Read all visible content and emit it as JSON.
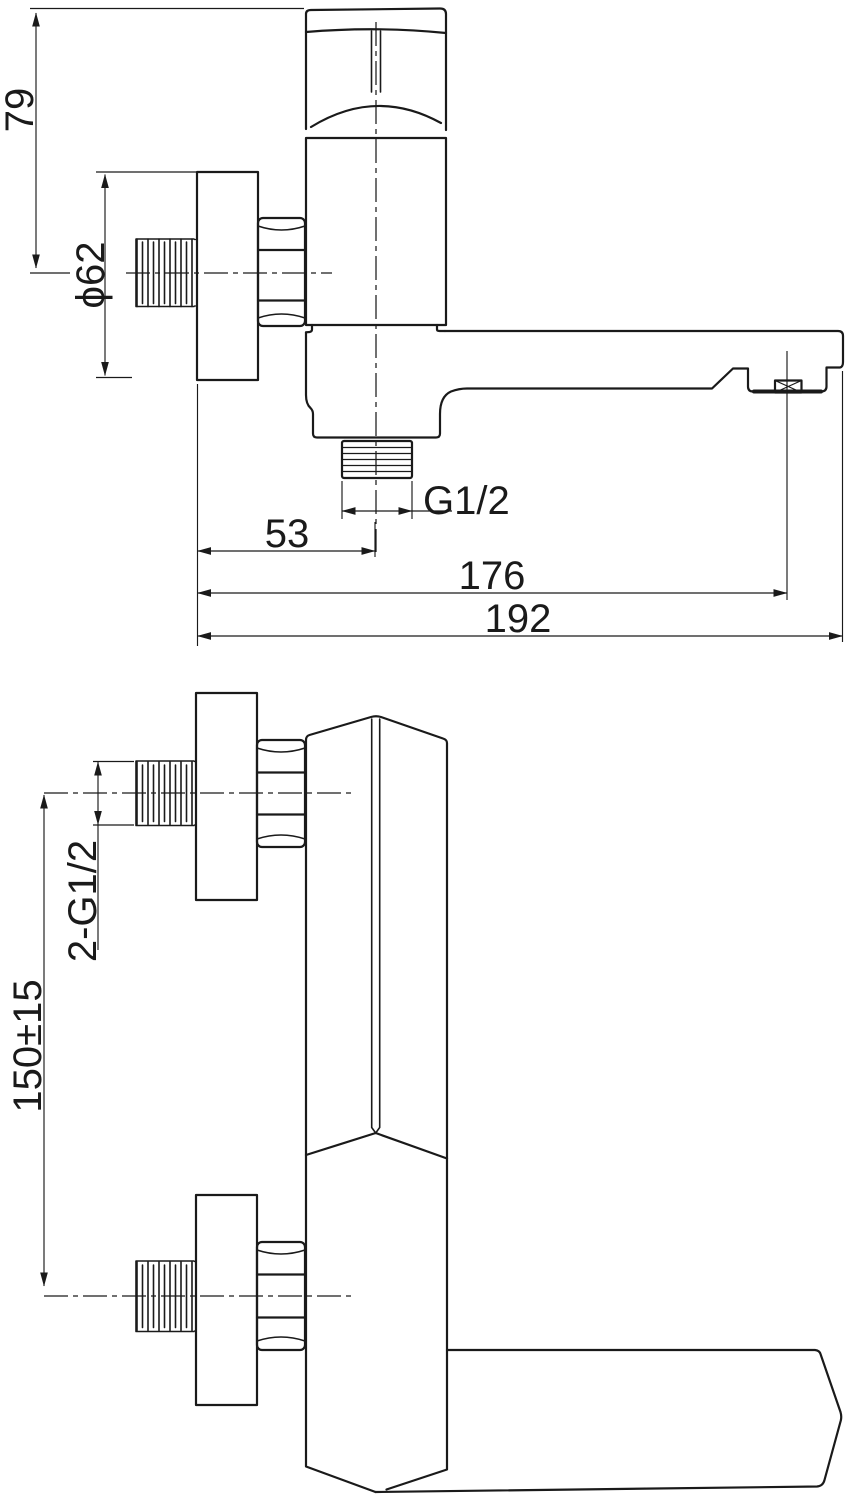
{
  "drawing": {
    "background": "#ffffff",
    "line_color": "#1a1a1a",
    "labels": {
      "height_79": "79",
      "flange_diameter": "ϕ62",
      "outlet_thread": "G1/2",
      "outlet_offset": "53",
      "aerator_reach": "176",
      "spout_reach": "192",
      "inlet_thread": "2-G1/2",
      "inlet_centers": "150±15"
    }
  }
}
